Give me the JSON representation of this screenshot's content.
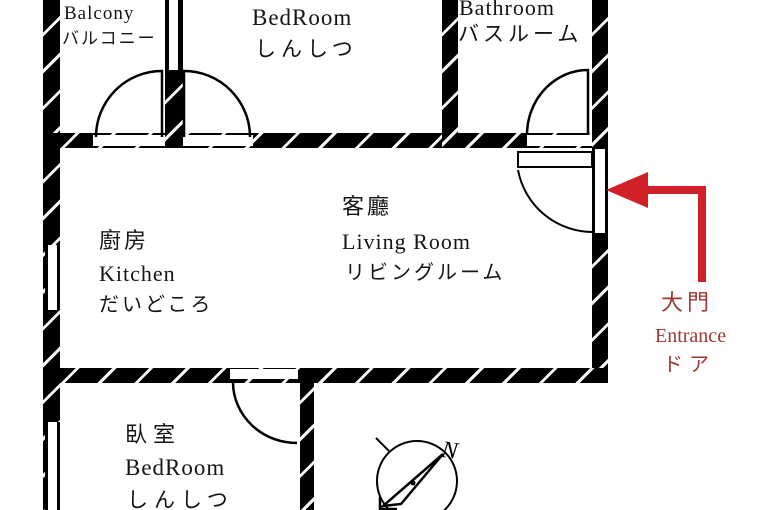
{
  "rooms": {
    "balcony": {
      "en": "Balcony",
      "ja": "バルコニー"
    },
    "bedroom_top": {
      "zh": "臥室",
      "en": "BedRoom",
      "ja": "しんしつ"
    },
    "bathroom": {
      "en": "Bathroom",
      "ja": "バスルーム"
    },
    "kitchen": {
      "zh": "廚房",
      "en": "Kitchen",
      "ja": "だいどころ"
    },
    "living_room": {
      "zh": "客廳",
      "en": "Living Room",
      "ja": "リビングルーム"
    },
    "bedroom_bottom": {
      "zh": "臥室",
      "en": "BedRoom",
      "ja": "しんしつ"
    }
  },
  "entrance": {
    "zh": "大門",
    "en": "Entrance",
    "ja": "ドア"
  },
  "compass": {
    "north_label": "N"
  },
  "colors": {
    "wall": "#000000",
    "background": "#ffffff",
    "entrance_arrow": "#cf2127",
    "entrance_text": "#9d3732"
  }
}
